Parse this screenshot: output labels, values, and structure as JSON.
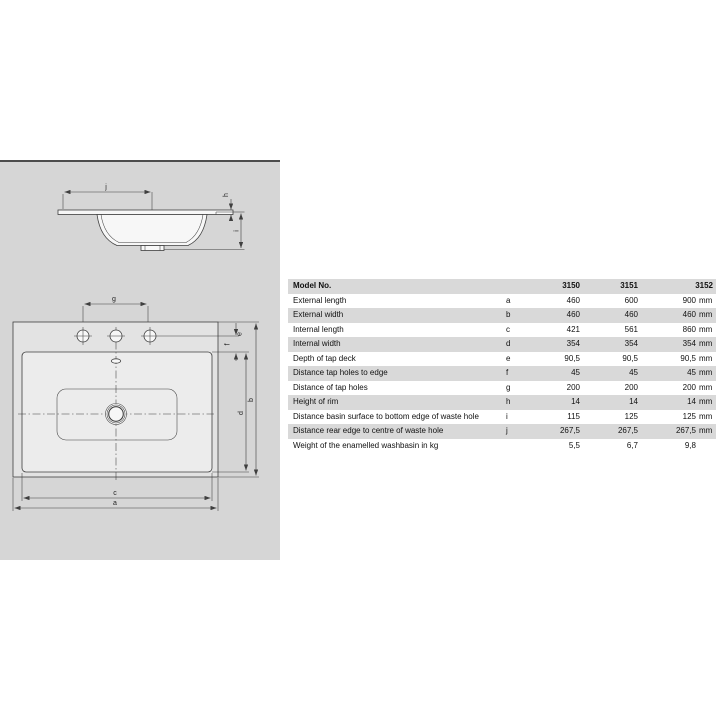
{
  "drawing": {
    "labels": {
      "a": "a",
      "b": "b",
      "c": "c",
      "d": "d",
      "e": "e",
      "f": "f",
      "g": "g",
      "h": "h",
      "i": "i",
      "j": "j"
    }
  },
  "table": {
    "header": {
      "label": "Model No.",
      "models": [
        "3150",
        "3151",
        "3152"
      ]
    },
    "rows": [
      {
        "label": "External length",
        "letter": "a",
        "values": [
          "460",
          "600",
          "900"
        ],
        "unit": "mm"
      },
      {
        "label": "External width",
        "letter": "b",
        "values": [
          "460",
          "460",
          "460"
        ],
        "unit": "mm"
      },
      {
        "label": "Internal length",
        "letter": "c",
        "values": [
          "421",
          "561",
          "860"
        ],
        "unit": "mm"
      },
      {
        "label": "Internal width",
        "letter": "d",
        "values": [
          "354",
          "354",
          "354"
        ],
        "unit": "mm"
      },
      {
        "label": "Depth of tap deck",
        "letter": "e",
        "values": [
          "90,5",
          "90,5",
          "90,5"
        ],
        "unit": "mm"
      },
      {
        "label": "Distance tap holes to edge",
        "letter": "f",
        "values": [
          "45",
          "45",
          "45"
        ],
        "unit": "mm"
      },
      {
        "label": "Distance of tap holes",
        "letter": "g",
        "values": [
          "200",
          "200",
          "200"
        ],
        "unit": "mm"
      },
      {
        "label": "Height of rim",
        "letter": "h",
        "values": [
          "14",
          "14",
          "14"
        ],
        "unit": "mm"
      },
      {
        "label": "Distance basin surface to bottom edge of waste hole",
        "letter": "i",
        "values": [
          "115",
          "125",
          "125"
        ],
        "unit": "mm"
      },
      {
        "label": "Distance rear edge to centre of waste hole",
        "letter": "j",
        "values": [
          "267,5",
          "267,5",
          "267,5"
        ],
        "unit": "mm"
      },
      {
        "label": "Weight of the enamelled washbasin in kg",
        "letter": "",
        "values": [
          "5,5",
          "6,7",
          "9,8"
        ],
        "unit": ""
      }
    ]
  },
  "colors": {
    "panel_bg": "#d6d6d6",
    "panel_top_border": "#4d4d4d",
    "row_stripe": "#d9d9d9",
    "drawing_line": "#3f3f3f"
  }
}
